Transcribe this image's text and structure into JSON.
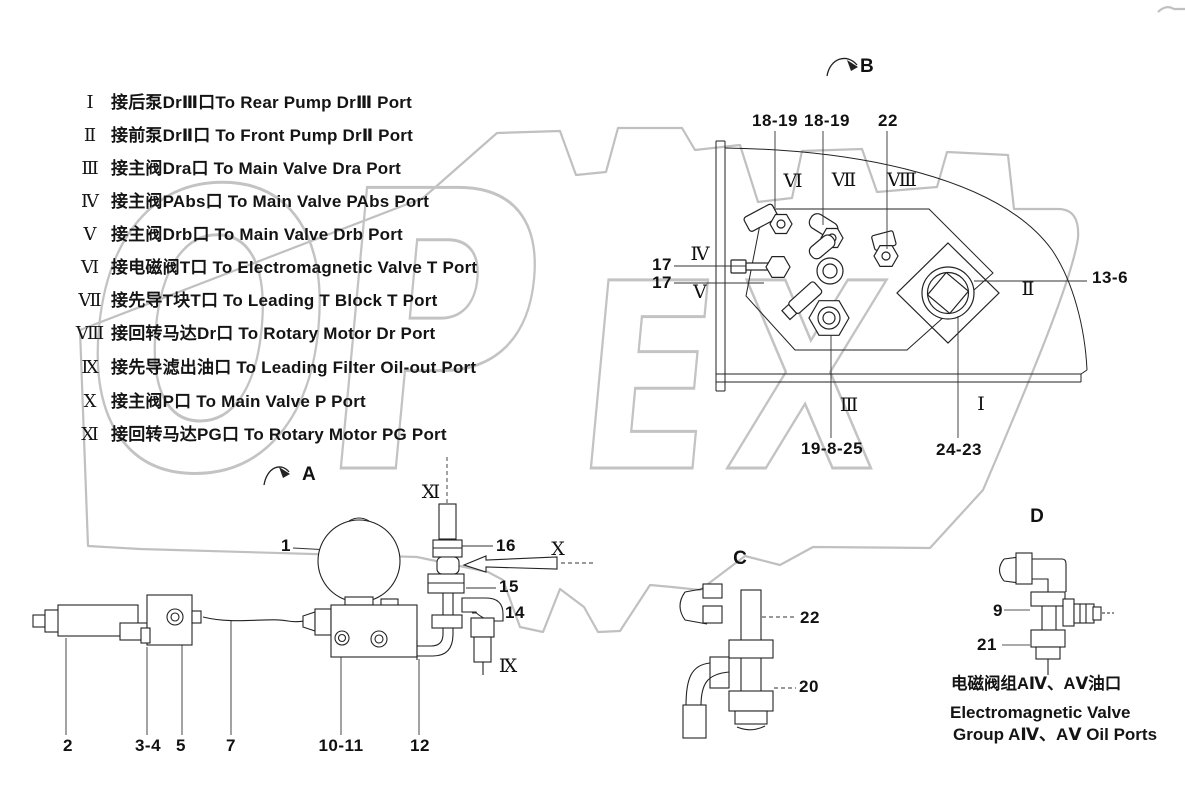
{
  "watermark": {
    "part1": "OP",
    "part2": "EX"
  },
  "legend": {
    "items": [
      {
        "numeral": "Ⅰ",
        "text": "接后泵DrⅢ口To Rear Pump DrⅢ Port"
      },
      {
        "numeral": "Ⅱ",
        "text": "接前泵DrⅡ口 To Front Pump DrⅡ Port"
      },
      {
        "numeral": "Ⅲ",
        "text": "接主阀Dra口 To Main Valve Dra Port"
      },
      {
        "numeral": "Ⅳ",
        "text": "接主阀PAbs口 To Main Valve PAbs Port"
      },
      {
        "numeral": "Ⅴ",
        "text": "接主阀Drb口 To Main Valve Drb Port"
      },
      {
        "numeral": "Ⅵ",
        "text": "接电磁阀T口 To Electromagnetic Valve T Port"
      },
      {
        "numeral": "Ⅶ",
        "text": "接先导T块T口 To Leading T Block T Port"
      },
      {
        "numeral": "Ⅷ",
        "text": "接回转马达Dr口 To Rotary Motor Dr Port"
      },
      {
        "numeral": "Ⅸ",
        "text": "接先导滤出油口  To Leading Filter Oil-out Port"
      },
      {
        "numeral": "Ⅹ",
        "text": "接主阀P口   To Main Valve P Port"
      },
      {
        "numeral": "Ⅺ",
        "text": "接回转马达PG口 To Rotary Motor PG Port"
      }
    ]
  },
  "callouts": {
    "b": {
      "view": "B",
      "t1": "18-19",
      "t2": "18-19",
      "t3": "22",
      "vi": "Ⅵ",
      "vii": "Ⅶ",
      "viii": "Ⅷ",
      "n17a": "17",
      "n17b": "17",
      "iv": "Ⅳ",
      "v": "Ⅴ",
      "ii": "Ⅱ",
      "n136": "13-6",
      "iii": "Ⅲ",
      "i": "Ⅰ",
      "n19825": "19-8-25",
      "n2423": "24-23"
    },
    "a": {
      "view": "A",
      "xi": "Ⅺ",
      "n1": "1",
      "n16": "16",
      "x": "Ⅹ",
      "n15": "15",
      "n14": "14",
      "ix": "Ⅸ",
      "n2": "2",
      "n34": "3-4",
      "n5": "5",
      "n7": "7",
      "n1011": "10-11",
      "n12": "12"
    },
    "c": {
      "view": "C",
      "n22": "22",
      "n20": "20"
    },
    "d": {
      "view": "D",
      "n9": "9",
      "n21": "21",
      "cap_zh": "电磁阀组AⅣ、AⅤ油口",
      "cap_en1": "Electromagnetic Valve",
      "cap_en2": "Group AⅣ、AⅤ Oil Ports"
    }
  }
}
